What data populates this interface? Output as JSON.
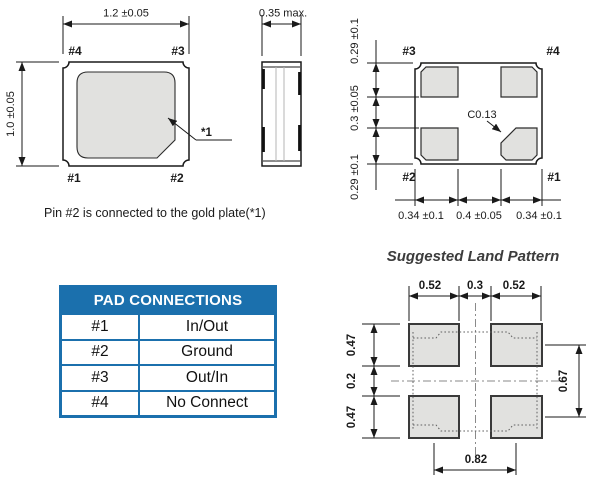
{
  "colors": {
    "table_blue": "#1b70ad",
    "pad_fill": "#e1e1df",
    "line": "#1a1a1a"
  },
  "top_view": {
    "width_dim": "1.2 ±0.05",
    "height_dim": "1.0 ±0.05",
    "pin_top_left": "#4",
    "pin_top_right": "#3",
    "pin_bottom_left": "#1",
    "pin_bottom_right": "#2",
    "gold_plate_ref": "*1"
  },
  "side_view": {
    "thickness_dim": "0.35 max."
  },
  "bottom_view": {
    "pin_top_left": "#3",
    "pin_top_right": "#4",
    "pin_bottom_left": "#2",
    "pin_bottom_right": "#1",
    "corner_chamfer": "C0.13",
    "width_dims": [
      "0.34 ±0.1",
      "0.4 ±0.05",
      "0.34 ±0.1"
    ],
    "height_dims": [
      "0.29 ±0.1",
      "0.3 ±0.05",
      "0.29 ±0.1"
    ]
  },
  "note": "Pin #2 is connected to the gold plate(*1)",
  "pad_table": {
    "title": "PAD CONNECTIONS",
    "rows": [
      {
        "pad": "#1",
        "connection": "In/Out"
      },
      {
        "pad": "#2",
        "connection": "Ground"
      },
      {
        "pad": "#3",
        "connection": "Out/In"
      },
      {
        "pad": "#4",
        "connection": "No Connect"
      }
    ]
  },
  "land_pattern": {
    "title": "Suggested Land Pattern",
    "top_dims": [
      "0.52",
      "0.3",
      "0.52"
    ],
    "left_dims": [
      "0.47",
      "0.2",
      "0.47"
    ],
    "right_dim": "0.67",
    "bottom_dim": "0.82"
  }
}
